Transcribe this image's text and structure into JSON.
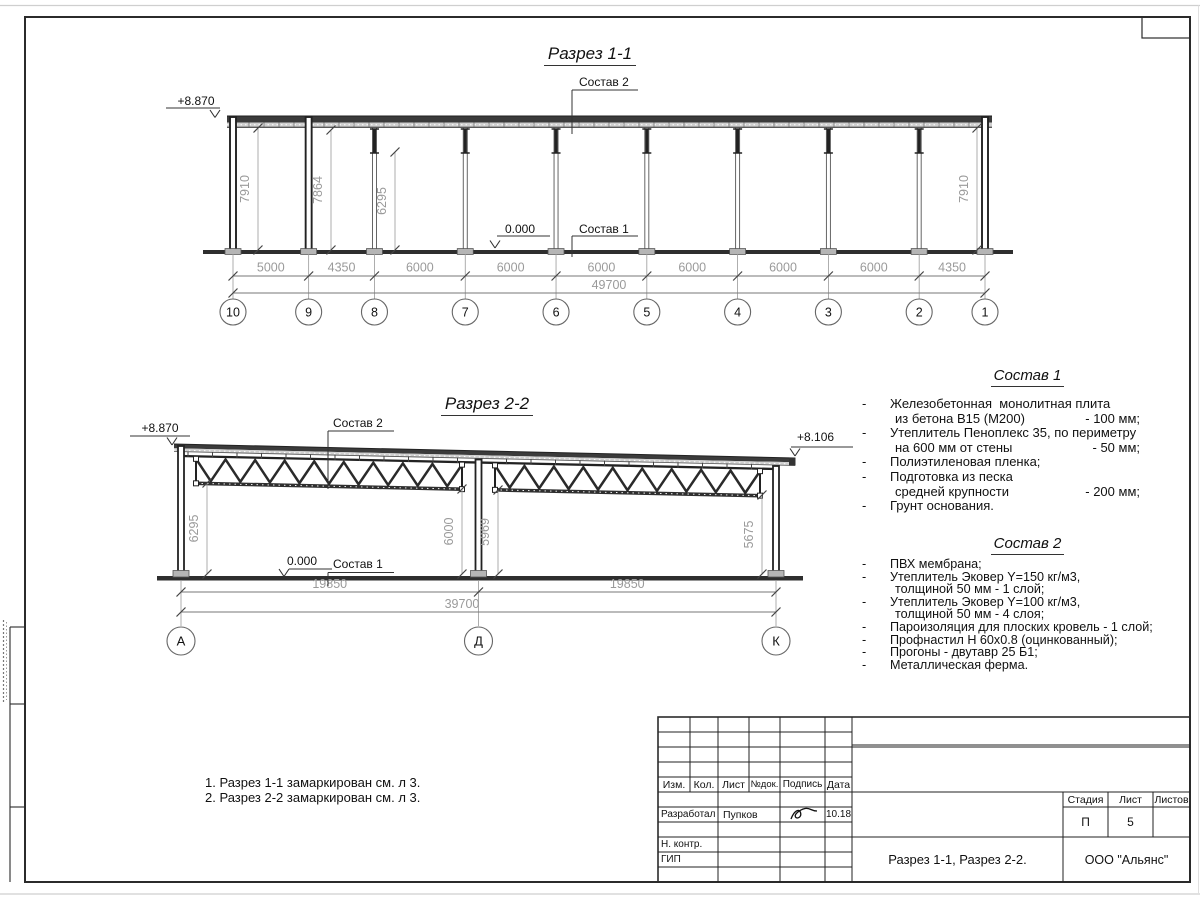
{
  "drawing": {
    "section1": {
      "title": "Разрез 1-1",
      "elevation": "+8.870",
      "zero_mark": "0.000",
      "callout_roof": "Состав 2",
      "callout_floor": "Состав 1",
      "axes": [
        "10",
        "9",
        "8",
        "7",
        "6",
        "5",
        "4",
        "3",
        "2",
        "1"
      ],
      "spans": [
        5000,
        4350,
        6000,
        6000,
        6000,
        6000,
        6000,
        6000,
        4350
      ],
      "span_labels": [
        "5000",
        "4350",
        "6000",
        "6000",
        "6000",
        "6000",
        "6000",
        "6000",
        "4350"
      ],
      "total_label": "49700",
      "height_dims": [
        "7910",
        "7864",
        "6295",
        "7910"
      ]
    },
    "section2": {
      "title": "Разрез 2-2",
      "elevation_left": "+8.870",
      "elevation_right": "+8.106",
      "zero_mark": "0.000",
      "callout_roof": "Состав 2",
      "callout_floor": "Состав 1",
      "axes": [
        "А",
        "Д",
        "К"
      ],
      "span_labels": [
        "19850",
        "19850"
      ],
      "total_label": "39700",
      "height_dims": [
        "6295",
        "6000",
        "5969",
        "5675"
      ]
    }
  },
  "composition1": {
    "title": "Состав 1",
    "items": [
      {
        "lines": [
          {
            "text": "Железобетонная  монолитная плита"
          },
          {
            "text": "из бетона В15 (М200)",
            "value": "- 100 мм;"
          }
        ]
      },
      {
        "lines": [
          {
            "text": "Утеплитель Пеноплекс 35, по периметру"
          },
          {
            "text": "на 600 мм от стены",
            "value": "- 50 мм;"
          }
        ]
      },
      {
        "lines": [
          {
            "text": "Полиэтиленовая пленка;"
          }
        ]
      },
      {
        "lines": [
          {
            "text": "Подготовка из песка"
          },
          {
            "text": "средней крупности",
            "value": "- 200 мм;"
          }
        ]
      },
      {
        "lines": [
          {
            "text": "Грунт основания."
          }
        ]
      }
    ]
  },
  "composition2": {
    "title": "Состав 2",
    "items": [
      {
        "lines": [
          {
            "text": "ПВХ мембрана;"
          }
        ]
      },
      {
        "lines": [
          {
            "text": "Утеплитель Эковер Y=150 кг/м3,"
          },
          {
            "text": "толщиной 50 мм - 1 слой;"
          }
        ]
      },
      {
        "lines": [
          {
            "text": "Утеплитель Эковер Y=100 кг/м3,"
          },
          {
            "text": "толщиной 50 мм - 4 слоя;"
          }
        ]
      },
      {
        "lines": [
          {
            "text": "Пароизоляция для плоских кровель - 1 слой;"
          }
        ]
      },
      {
        "lines": [
          {
            "text": "Профнастил Н 60х0.8 (оцинкованный);"
          }
        ]
      },
      {
        "lines": [
          {
            "text": "Прогоны - двутавр 25 Б1;"
          }
        ]
      },
      {
        "lines": [
          {
            "text": "Металлическая ферма."
          }
        ]
      }
    ]
  },
  "notes": [
    "1. Разрез 1-1 замаркирован см. л 3.",
    "2. Разрез 2-2 замаркирован см. л 3."
  ],
  "titleblock": {
    "header_cols": [
      "Изм.",
      "Кол.",
      "Лист",
      "№док.",
      "Подпись",
      "Дата"
    ],
    "developer_label": "Разработал",
    "developer_name": "Пупков",
    "developer_date": "10.18",
    "ncontr_label": "Н. контр.",
    "gip_label": "ГИП",
    "stage_label": "Стадия",
    "sheet_label": "Лист",
    "sheets_label": "Листов",
    "stage_value": "П",
    "sheet_value": "5",
    "doc_title": "Разрез 1-1, Разрез 2-2.",
    "company": "ООО \"Альянс\""
  }
}
